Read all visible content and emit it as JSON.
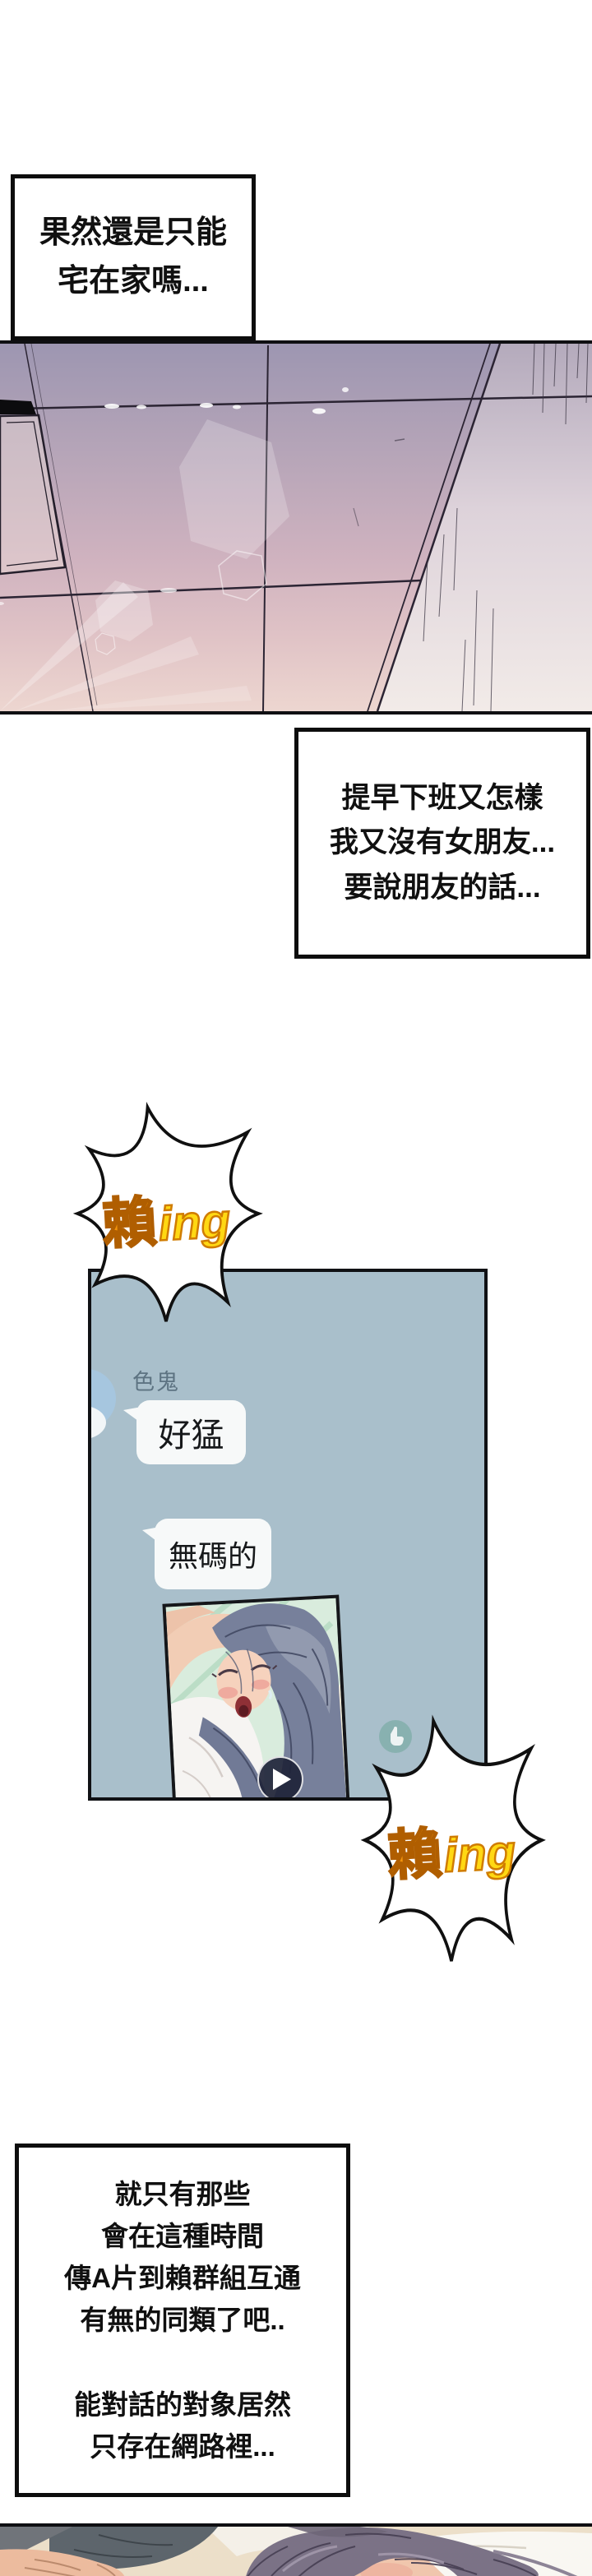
{
  "page": {
    "kind": "webtoon-comic-page",
    "background": "#ffffff"
  },
  "narration": {
    "box1": {
      "lines": [
        "果然還是只能",
        "宅在家嗎..."
      ]
    },
    "box2": {
      "lines": [
        "提早下班又怎樣",
        "我又沒有女朋友...",
        "要說朋友的話..."
      ]
    },
    "box3": {
      "lines": [
        "就只有那些",
        "會在這種時間",
        "傳A片到賴群組互通",
        "有無的同類了吧..",
        "",
        "能對話的對象居然",
        "只存在網路裡..."
      ]
    }
  },
  "sfx": {
    "bubble1": {
      "zh": "賴",
      "latin": "ing"
    },
    "bubble2": {
      "zh": "賴",
      "latin": "ing"
    }
  },
  "chat": {
    "sender_label": "色鬼",
    "messages": [
      "好猛",
      "無碼的"
    ],
    "icons": {
      "play": "play-icon",
      "tap": "pointer-hand-icon",
      "avatar": "avatar-circle"
    }
  },
  "colors": {
    "ink": "#0d0d0d",
    "chat_panel_bg": "#a9bfcb",
    "chat_bubble_bg": "#f7f9f9",
    "chat_sender_label": "#5d7382",
    "avatar_blue": "#a6c6df",
    "sfx_zh_fill": "#f1930c",
    "sfx_zh_stroke": "#b05e00",
    "sfx_latin_fill": "#ffd813",
    "sfx_latin_stroke": "#d07c00",
    "play_button_bg": "#1e2338",
    "tap_circle": "#6da69b",
    "ceiling_top": "#9d96b1",
    "ceiling_bottom": "#edd6d0"
  }
}
